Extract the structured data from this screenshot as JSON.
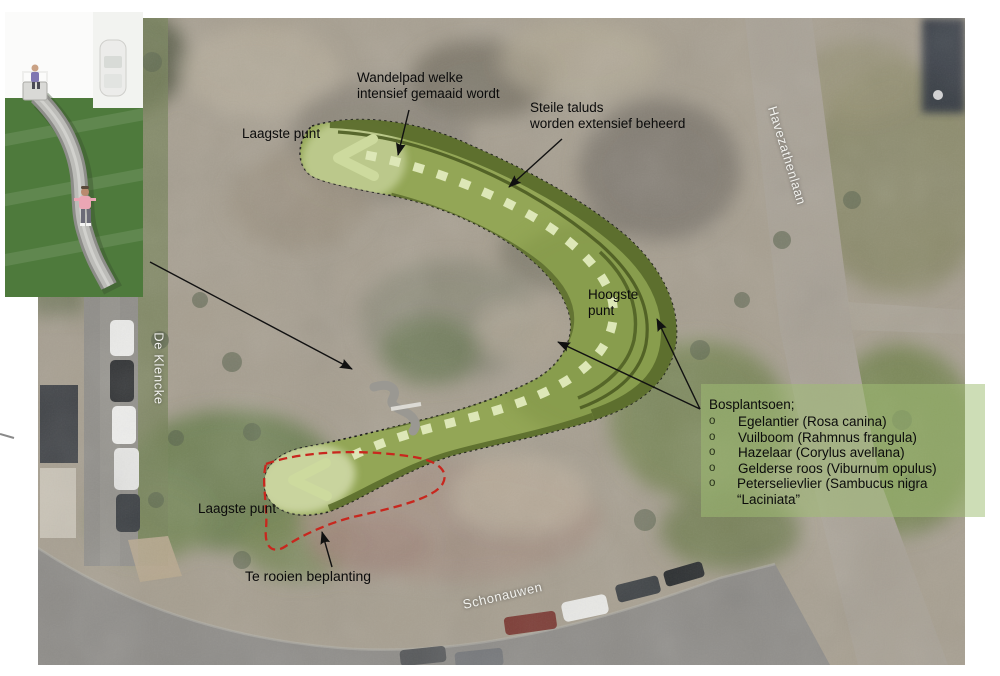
{
  "annotations": {
    "wandelpad": "Wandelpad welke\nintensief gemaaid wordt",
    "steile_taluds": "Steile taluds\nworden extensief beheerd",
    "laagste_punt_top": "Laagste punt",
    "hoogste_punt": "Hoogste\npunt",
    "laagste_punt_bottom": "Laagste punt",
    "te_rooien": "Te rooien beplanting"
  },
  "streets": {
    "left": "De Klencke",
    "right": "Havezathenlaan",
    "bottom": "Schonauwen"
  },
  "planting_panel": {
    "title": "Bosplantsoen;",
    "bullet": "o",
    "items": [
      "Egelantier (Rosa canina)",
      "Vuilboom (Rahmnus frangula)",
      "Hazelaar (Corylus avellana)",
      "Gelderse roos (Viburnum opulus)",
      "Peterselievlier (Sambucus nigra “Laciniata”"
    ]
  },
  "legend_colors": {
    "design_mound_green": "#93a656",
    "slope_band_dark_green": "#5b6d2c",
    "walk_path_cream": "#dde7b7",
    "removal_outline_red": "#c8271e",
    "panel_green": "rgba(160,190,115,0.52)"
  }
}
